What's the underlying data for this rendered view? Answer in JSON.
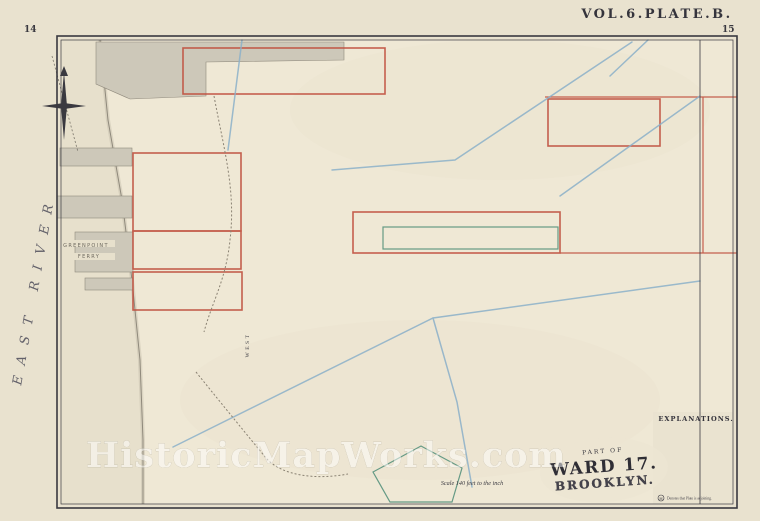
{
  "page": {
    "title": "VOL.6.PLATE.B.",
    "page_left": "14",
    "page_right": "15"
  },
  "map": {
    "river_label": "EAST RIVER",
    "ferry_line1": "GREENPOINT",
    "ferry_line2": "FERRY",
    "street_west": "WEST",
    "streets_horizontal": [
      {
        "name": "HURON",
        "nx": 268,
        "ny": 50,
        "suffix": "ST.",
        "sx": 545,
        "sy": 48
      },
      {
        "name": "INDIA",
        "nx": 262,
        "ny": 106,
        "suffix": "ST.",
        "sx": 556,
        "sy": 104
      },
      {
        "name": "JAVA",
        "nx": 260,
        "ny": 160,
        "suffix": "ST.",
        "sx": 540,
        "sy": 158
      },
      {
        "name": "KENT",
        "nx": 260,
        "ny": 213,
        "suffix": "ST.",
        "sx": 478,
        "sy": 211
      },
      {
        "name": "GREENPOINT",
        "nx": 262,
        "ny": 266,
        "suffix": "AVE.",
        "sx": 492,
        "sy": 264
      },
      {
        "name": "MILTON",
        "nx": 282,
        "ny": 319,
        "suffix": "ST.",
        "sx": 500,
        "sy": 317
      },
      {
        "name": "NOBLE",
        "nx": 295,
        "ny": 377,
        "suffix": "ST.",
        "sx": 540,
        "sy": 375
      },
      {
        "name": "OAK",
        "nx": 192,
        "ny": 431,
        "suffix": "ST.",
        "sx": 420,
        "sy": 429
      },
      {
        "name": "CALYER",
        "nx": 272,
        "ny": 485,
        "suffix": "ST.",
        "sx": 432,
        "sy": 483
      }
    ],
    "block_numbers": [
      {
        "n": "20",
        "x": 191,
        "y": 72
      },
      {
        "n": "47",
        "x": 444,
        "y": 70
      },
      {
        "n": "13",
        "x": 185,
        "y": 124
      },
      {
        "n": "70",
        "x": 634,
        "y": 123
      },
      {
        "n": "14",
        "x": 181,
        "y": 180
      },
      {
        "n": "45",
        "x": 457,
        "y": 180
      },
      {
        "n": "69",
        "x": 614,
        "y": 180
      },
      {
        "n": "19",
        "x": 153,
        "y": 234
      },
      {
        "n": "17",
        "x": 285,
        "y": 232
      },
      {
        "n": "68",
        "x": 614,
        "y": 233
      },
      {
        "n": "12",
        "x": 181,
        "y": 291
      },
      {
        "n": "16",
        "x": 294,
        "y": 290
      },
      {
        "n": "65",
        "x": 687,
        "y": 320
      },
      {
        "n": "7",
        "x": 175,
        "y": 345
      },
      {
        "n": "11",
        "x": 292,
        "y": 348
      },
      {
        "n": "42",
        "x": 420,
        "y": 346
      },
      {
        "n": "6",
        "x": 184,
        "y": 401
      },
      {
        "n": "10",
        "x": 290,
        "y": 403
      },
      {
        "n": "5",
        "x": 175,
        "y": 456
      },
      {
        "n": "9",
        "x": 292,
        "y": 456
      },
      {
        "n": "37",
        "x": 404,
        "y": 455
      }
    ],
    "annotations": [
      {
        "text": "Nicholas Wyckoff et al",
        "x": 268,
        "y": 63,
        "rot": -3,
        "size": 7.5
      },
      {
        "text": "No 485",
        "x": 240,
        "y": 74,
        "rot": -3,
        "size": 6.5
      },
      {
        "text": "Filed March 14th 1846",
        "x": 272,
        "y": 85,
        "rot": -3,
        "size": 7
      },
      {
        "text": "Nicholas N. Wyckoff",
        "x": 600,
        "y": 113,
        "rot": -2,
        "size": 6.5
      },
      {
        "text": "Estate No 485.",
        "x": 592,
        "y": 123,
        "rot": -2,
        "size": 6
      },
      {
        "text": "Filed March 14th 1843.",
        "x": 602,
        "y": 134,
        "rot": -2,
        "size": 6
      },
      {
        "text": "Greenpoint Farm to John Meserole",
        "x": 487,
        "y": 126,
        "rot": 3,
        "size": 10,
        "spread": 5
      },
      {
        "text": "Filed Apr 30th 1840",
        "x": 642,
        "y": 215,
        "rot": -8,
        "size": 9
      },
      {
        "text": "Mortgage No 366, Page 194, Dec 17th 1853",
        "x": 470,
        "y": 233,
        "rot": 2,
        "size": 5.5
      },
      {
        "text": "Edw. Clark",
        "x": 523,
        "y": 245,
        "rot": 0,
        "size": 7
      },
      {
        "text": "Map of",
        "x": 306,
        "y": 240,
        "rot": 22,
        "size": 8
      },
      {
        "text": "300",
        "x": 352,
        "y": 265,
        "rot": 12,
        "size": 7.5
      },
      {
        "text": "J. Williamson",
        "x": 208,
        "y": 190,
        "rot": 72,
        "size": 7
      },
      {
        "text": "Williamsburgh Turnpike Road",
        "x": 238,
        "y": 425,
        "rot": 48,
        "size": 6.5
      },
      {
        "text": "Peter Calyer",
        "x": 514,
        "y": 452,
        "rot": -12,
        "size": 8
      },
      {
        "text": "Part of No 767.",
        "x": 664,
        "y": 62,
        "rot": -2,
        "size": 6.5
      },
      {
        "text": "Part of No 219.",
        "x": 661,
        "y": 86,
        "rot": -2,
        "size": 6.5
      },
      {
        "text": "Filed Jan 30th 1840",
        "x": 699,
        "y": 185,
        "rot": 80,
        "size": 6
      }
    ],
    "industrial_labels": [
      {
        "text": "LUMBER YD.",
        "x": 163,
        "y": 64,
        "size": 4.2
      },
      {
        "text": "LUMBER YARD",
        "x": 210,
        "y": 117,
        "size": 4.2
      },
      {
        "text": "COAL",
        "x": 368,
        "y": 119,
        "size": 3.6
      },
      {
        "text": "YARD",
        "x": 368,
        "y": 124,
        "size": 3.6
      },
      {
        "text": "PLANING MILL",
        "x": 207,
        "y": 136,
        "size": 3.8
      },
      {
        "text": "CONTINENTAL",
        "x": 137,
        "y": 459,
        "size": 3.8
      },
      {
        "text": "IRON WORKS",
        "x": 137,
        "y": 465,
        "size": 3.8
      }
    ],
    "plate_circles": [
      {
        "letter": "A",
        "x": 407,
        "y": 25
      },
      {
        "letter": "C",
        "x": 283,
        "y": 495
      },
      {
        "letter": "D",
        "x": 719,
        "y": 118
      },
      {
        "letter": "E",
        "x": 716,
        "y": 403
      }
    ]
  },
  "legend": {
    "title": "EXPLANATIONS.",
    "entries": [
      {
        "swatch": "pair-pink",
        "label": "Brick or Stone Buildings."
      },
      {
        "swatch": "pair-yellow",
        "label": "Frame Buildings."
      },
      {
        "swatch": "pair-pink",
        "label": "Brick & Stone Stables."
      },
      {
        "swatch": "pair-yellow",
        "label": "Frame Stable or Shed."
      },
      {
        "swatch": "line-red",
        "label": "Old Farm Lines."
      },
      {
        "swatch": "line-blue",
        "label": "Old Water Courses."
      },
      {
        "swatch": "line-dark",
        "label": "Sewers."
      },
      {
        "swatch": "line-dark",
        "label": "Water Pipes & Size in Inches."
      },
      {
        "swatch": "line-dark",
        "label": "Gas Pipes & Size in Inches."
      },
      {
        "swatch": "dot",
        "label": "Fire Hydrants."
      },
      {
        "swatch": "text",
        "swatch_text": "47",
        "label": "Block Numbers."
      },
      {
        "swatch": "text",
        "swatch_text": "12",
        "label": "Lot Numbers."
      },
      {
        "swatch": "text",
        "swatch_text": "20",
        "label": "No. of Blocks in the Wards."
      },
      {
        "swatch": "text",
        "swatch_text": "12''",
        "label": "Diameters Marked thus."
      },
      {
        "swatch": "text",
        "swatch_text": "17",
        "label": "Ward Numbers."
      },
      {
        "swatch": "text",
        "swatch_text": "9.6",
        "label": "Heights in feet above tide."
      }
    ],
    "note_symbol": "H",
    "note_text": "Denotes that Plate is adjoining."
  },
  "badge": {
    "part_of": "PART OF",
    "ward": "WARD 17.",
    "city": "BROOKLYN."
  },
  "scale_bar": {
    "label": "Scale 140 feet to the inch",
    "ticks": [
      "0",
      "140",
      "280",
      "420",
      "560"
    ]
  },
  "watermark": "HistoricMapWorks.com",
  "colors": {
    "paper": "#e9e2cf",
    "inner": "#efe8d5",
    "water": "#e7e0cc",
    "street": "#f3edd9",
    "ink": "#3a3940",
    "red": "#c0503f",
    "blue": "#8bb0c9",
    "green": "#55917c",
    "pink": "#e3c4b2",
    "yellow": "#e6d6a3",
    "tan": "#d6ba84",
    "pinkdark": "#dda18c",
    "gray": "#cdc8b9"
  }
}
